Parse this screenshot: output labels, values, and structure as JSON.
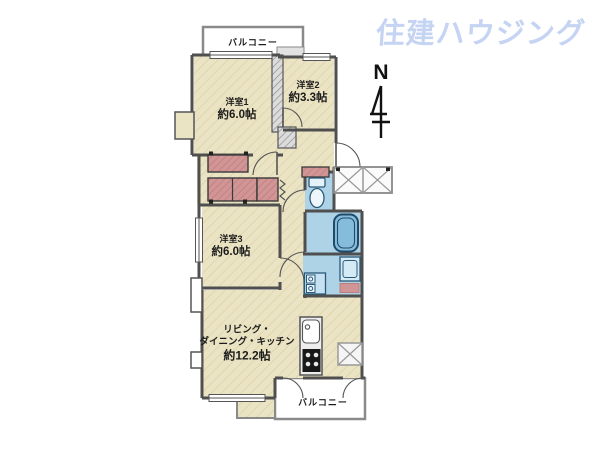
{
  "watermark": {
    "text": "住建ハウジング",
    "color": "#c5d4f2"
  },
  "compass": {
    "north_label": "N"
  },
  "rooms": {
    "balcony_top": {
      "label": "バルコニー"
    },
    "bedroom1": {
      "name": "洋室1",
      "area": "約6.0帖"
    },
    "bedroom2": {
      "name": "洋室2",
      "area": "約3.3帖"
    },
    "bedroom3": {
      "name": "洋室3",
      "area": "約6.0帖"
    },
    "ldk": {
      "name_line1": "リビング・",
      "name_line2": "ダイニング・キッチン",
      "area": "約12.2帖"
    },
    "balcony_bottom": {
      "label": "バルコニー"
    }
  },
  "legend": {
    "floor_color": "#ebe4c4",
    "wet_area_color": "#aed2e6",
    "closet_color": "#d29595",
    "wall_color": "#4f4f4f",
    "bathtub_color": "#85bcdc"
  }
}
